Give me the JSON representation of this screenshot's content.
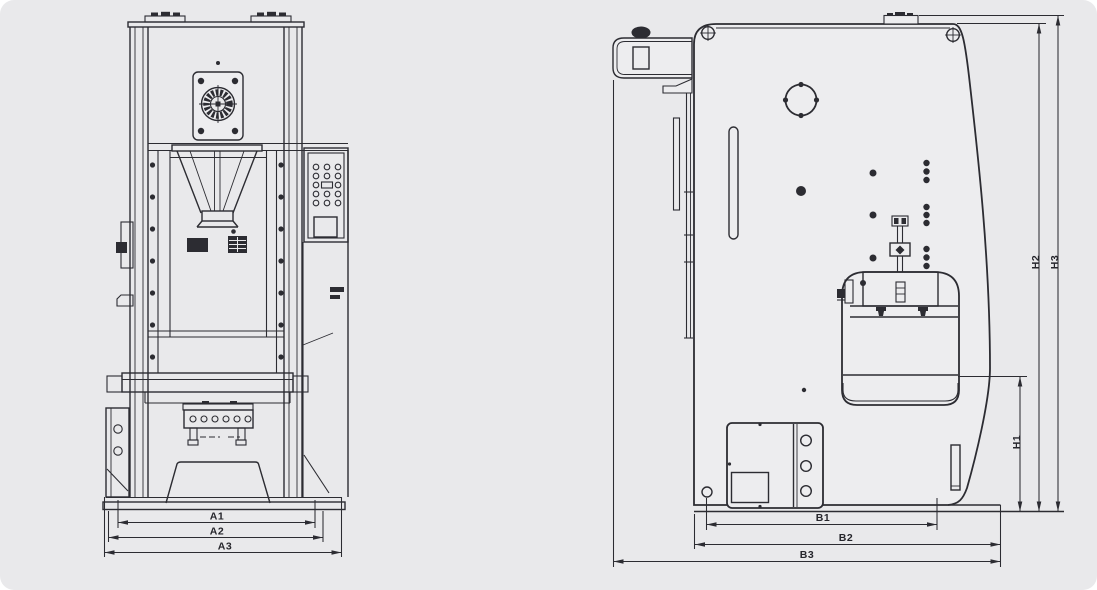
{
  "canvas": {
    "background": "#e9e9eb",
    "line_color": "#2c2c32",
    "body_fill": "#ededef",
    "label_color": "#26262c"
  },
  "views": {
    "front": {
      "dim_labels": {
        "a1": "A1",
        "a2": "A2",
        "a3": "A3"
      }
    },
    "side": {
      "depth_labels": {
        "b1": "B1",
        "b2": "B2",
        "b3": "B3"
      },
      "height_labels": {
        "h1": "H1",
        "h2": "H2",
        "h3": "H3"
      }
    }
  }
}
